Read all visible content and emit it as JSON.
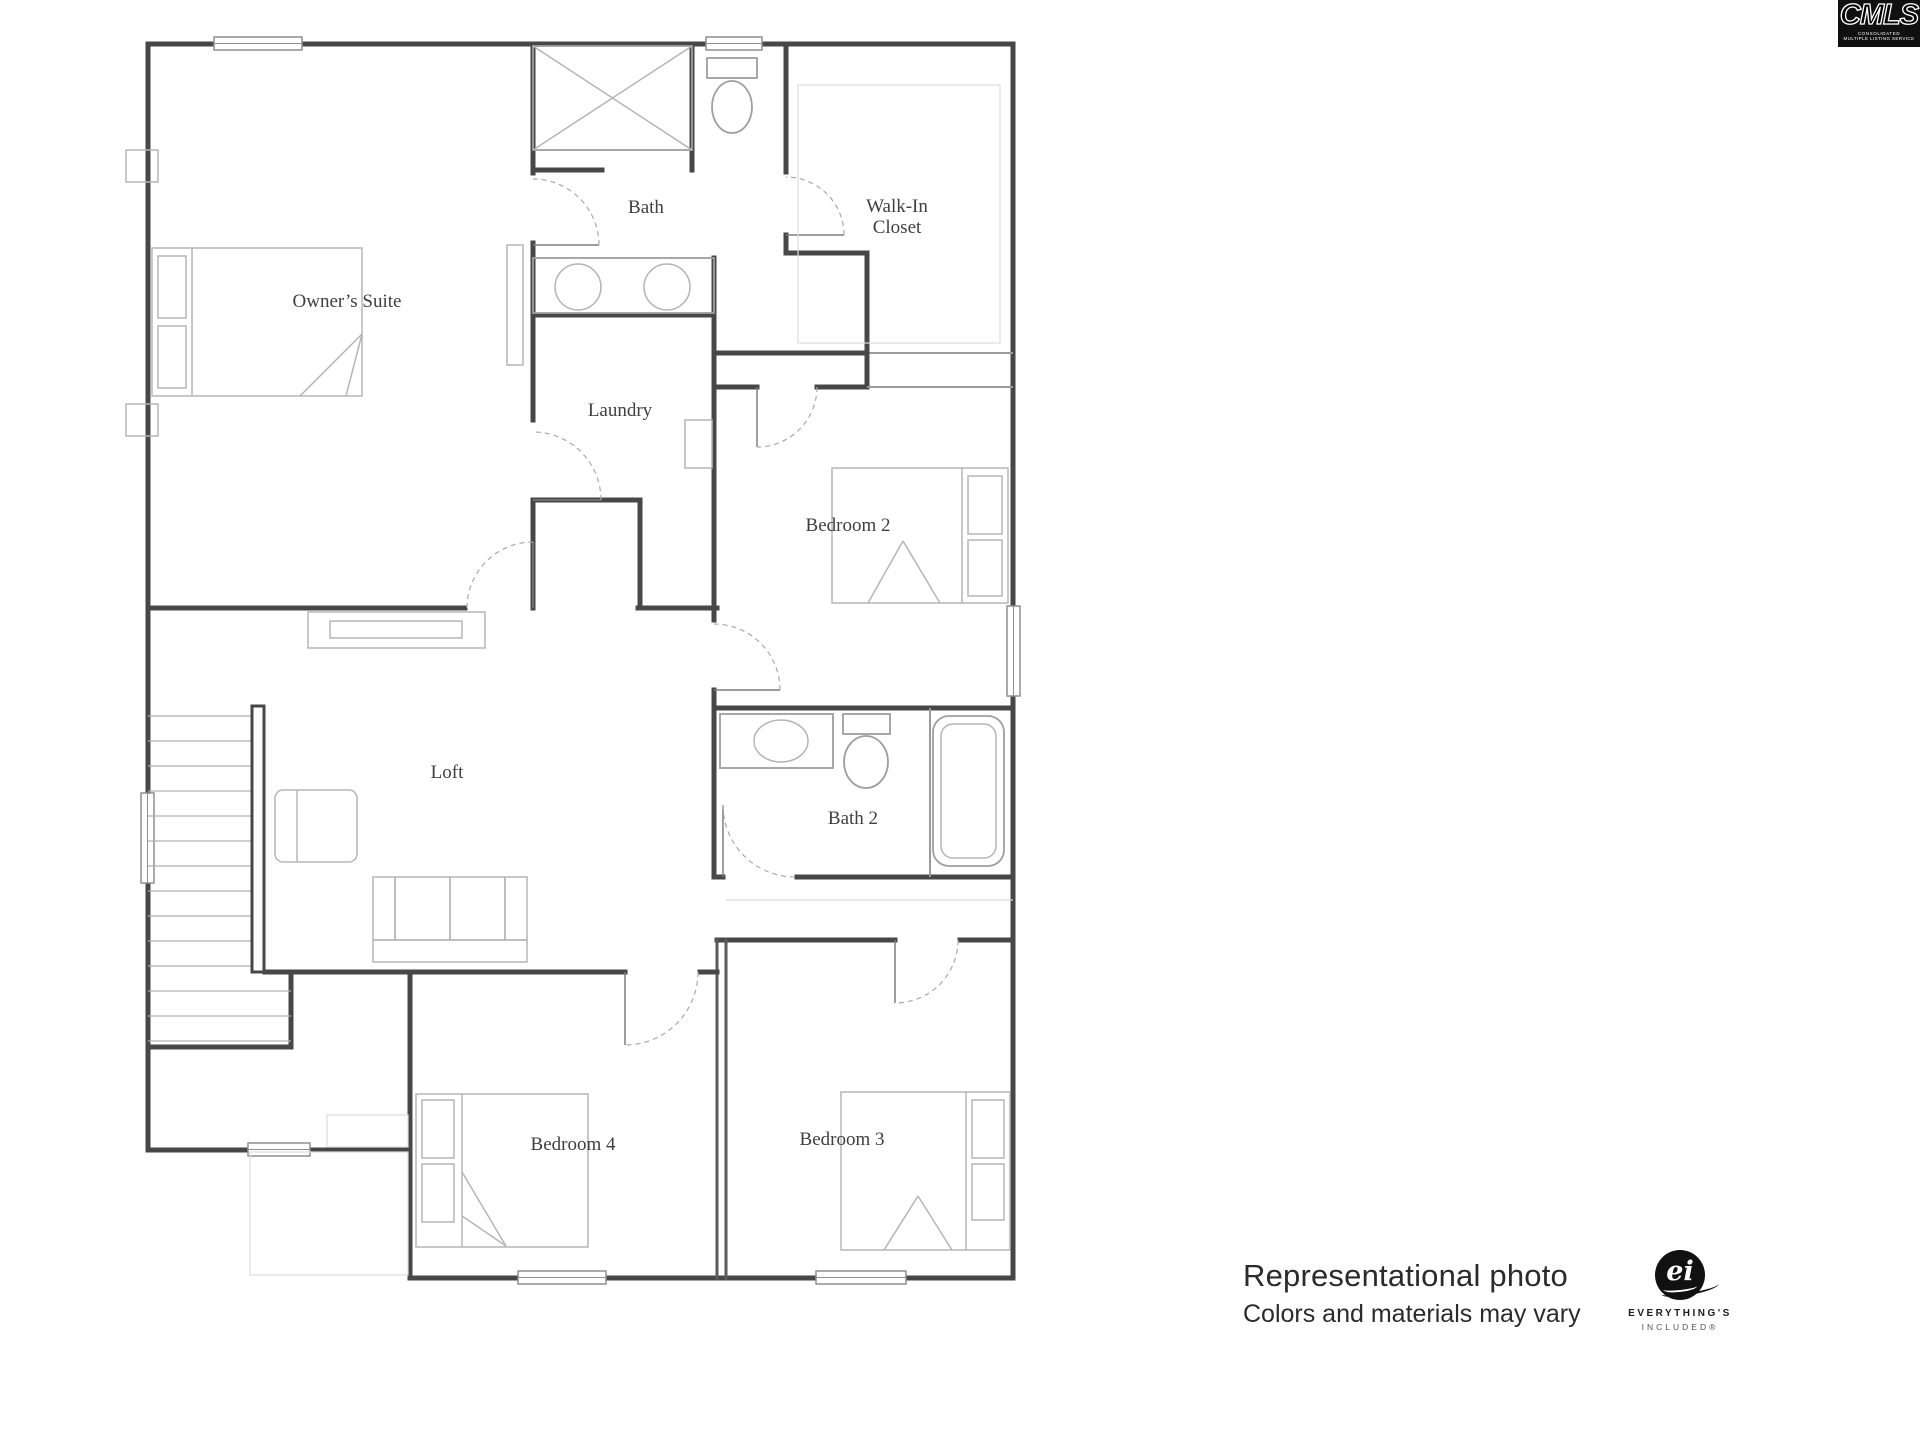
{
  "page": {
    "background": "#ffffff"
  },
  "floor_plan": {
    "line_color": "#474747",
    "furniture_color": "#b5b5b5",
    "rooms": [
      {
        "id": "owners_suite",
        "label": "Owner’s Suite"
      },
      {
        "id": "bath",
        "label": "Bath"
      },
      {
        "id": "walk_in_closet",
        "label": "Walk-In Closet",
        "line1": "Walk-In",
        "line2": "Closet"
      },
      {
        "id": "laundry",
        "label": "Laundry"
      },
      {
        "id": "bedroom_2",
        "label": "Bedroom 2"
      },
      {
        "id": "loft",
        "label": "Loft"
      },
      {
        "id": "bath_2",
        "label": "Bath 2"
      },
      {
        "id": "bedroom_4",
        "label": "Bedroom 4"
      },
      {
        "id": "bedroom_3",
        "label": "Bedroom 3"
      }
    ]
  },
  "footer": {
    "line1": "Representational photo",
    "line2": "Colors and materials may vary"
  },
  "logos": {
    "cmls": {
      "text": "CMLS",
      "caption_line1": "CONSOLIDATED",
      "caption_line2": "MULTIPLE LISTING SERVICE",
      "bg": "#101010"
    },
    "everythings_included": {
      "monogram": "ei",
      "line1": "EVERYTHING'S",
      "line2": "INCLUDED®"
    }
  }
}
